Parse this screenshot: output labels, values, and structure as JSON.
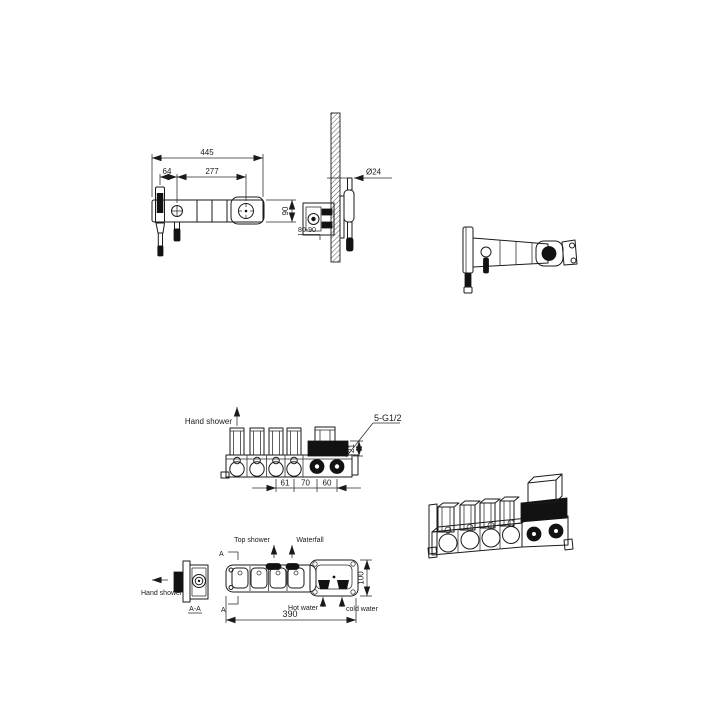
{
  "drawing": {
    "front_view": {
      "dim_total_width": "445",
      "dim_center_spacing": "277",
      "dim_hand_shower_offset": "64",
      "dim_height": "90"
    },
    "side_view": {
      "dim_diameter": "Ø24",
      "dim_depth_range": "80-90"
    },
    "rough_front_view": {
      "hand_shower_label": "Hand shower",
      "thread_label": "5-G1/2",
      "dim_spacing_a": "61",
      "dim_spacing_b": "70",
      "dim_spacing_c": "60",
      "dim_height": "21"
    },
    "section_view": {
      "hand_shower_label": "Hand  shower",
      "section_label": "A-A"
    },
    "plan_view": {
      "top_shower_label": "Top shower",
      "waterfall_label": "Waterfall",
      "hot_water_label": "Hot water",
      "cold_water_label": "cold water",
      "dim_length": "390",
      "dim_depth": "100",
      "section_mark_top": "A",
      "section_mark_bottom": "A"
    },
    "colors": {
      "line": "#1a1a1a",
      "dark_fill": "#121212",
      "background": "#ffffff"
    }
  }
}
